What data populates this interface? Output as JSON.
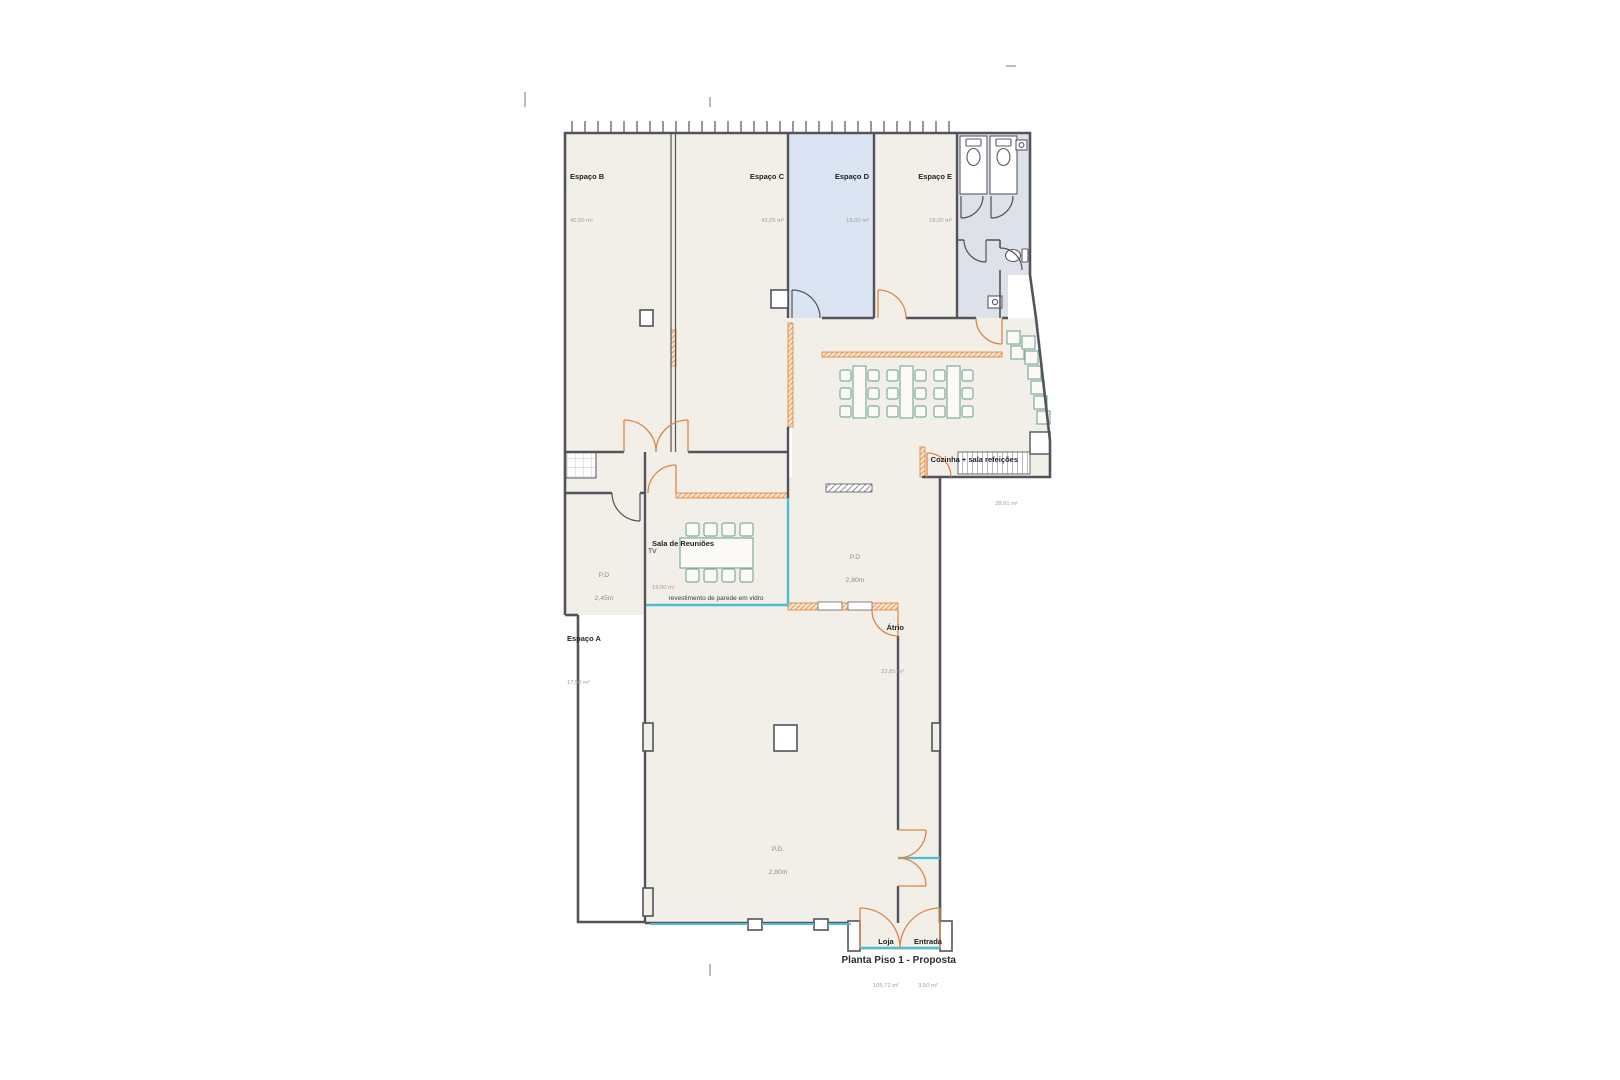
{
  "sheet": {
    "title": "Planta Piso 1 - Proposta"
  },
  "rooms": {
    "espaco_b": {
      "name": "Espaço B",
      "area": "40,00 m²"
    },
    "espaco_c": {
      "name": "Espaço C",
      "area": "43,05 m²"
    },
    "espaco_d": {
      "name": "Espaço D",
      "area": "18,00 m²"
    },
    "espaco_e": {
      "name": "Espaço E",
      "area": "18,00 m²"
    },
    "cozinha": {
      "name": "Cozinha + sala refeições",
      "area": "38,91 m²"
    },
    "sala_reunioes": {
      "name": "Sala de Reuniões",
      "area": "19,00 m²"
    },
    "atrio": {
      "name": "Átrio",
      "area": "22,85 m²"
    },
    "espaco_a": {
      "name": "Espaço A",
      "area": "17,50 m²"
    },
    "loja": {
      "name": "Loja",
      "area": "105,72 m²"
    },
    "entrada": {
      "name": "Entrada",
      "area": "3,50 m²"
    }
  },
  "annotations": {
    "pd_espaco_a": {
      "label": "P.D",
      "value": "2,45m"
    },
    "pd_atrio": {
      "label": "P.D",
      "value": "2,80m"
    },
    "pd_loja": {
      "label": "P.D.",
      "value": "2,80m"
    },
    "tv": "TV",
    "glass_wall_note": "revestimento de parede em vidro"
  },
  "colors": {
    "floor_fill": "#f1efe8",
    "highlight_room_fill": "#dae4f2",
    "wet_area_fill": "#dde1e9",
    "wall": "#53545a",
    "proposed_wall_orange": "#dd8549",
    "glass_cyan": "#4fbccf",
    "furniture_teal": "#7fae9f"
  }
}
